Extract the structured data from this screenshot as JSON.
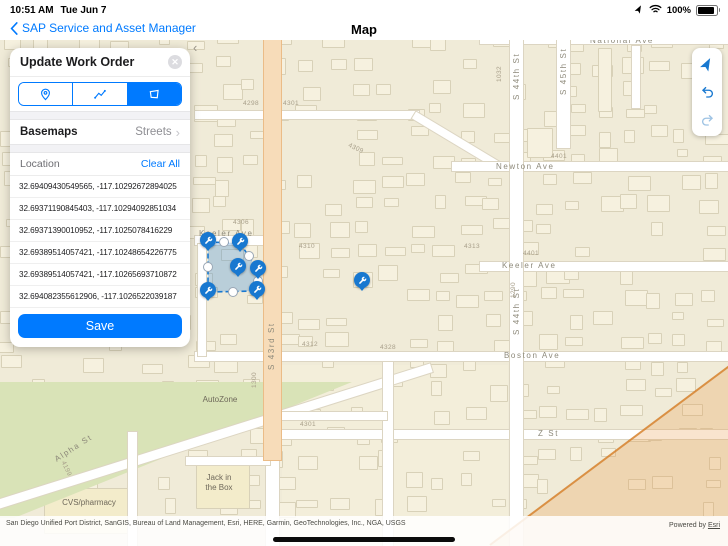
{
  "status_bar": {
    "time": "10:51 AM",
    "date": "Tue Jun 7",
    "battery": "100%"
  },
  "nav_bar": {
    "back_label": "SAP Service and Asset Manager",
    "title": "Map"
  },
  "panel": {
    "title": "Update Work Order",
    "tools": [
      {
        "name": "point",
        "selected": false
      },
      {
        "name": "polyline",
        "selected": false
      },
      {
        "name": "polygon",
        "selected": true
      }
    ],
    "basemaps_label": "Basemaps",
    "basemaps_value": "Streets",
    "location_label": "Location",
    "clear_all_label": "Clear All",
    "coordinates": [
      "32.69409430549565, -117.10292672894025",
      "32.69371190845403, -117.10294092851034",
      "32.69371390010952, -117.1025078416229",
      "32.69389514057421, -117.10248654226775",
      "32.69389514057421, -117.10265693710872",
      "32.694082355612906, -117.1026522039187"
    ],
    "save_label": "Save"
  },
  "map": {
    "street_labels": [
      {
        "text": "National Ave",
        "x": 590,
        "y": -4,
        "rot": 0
      },
      {
        "text": "Newton Ave",
        "x": 496,
        "y": 122,
        "rot": 0
      },
      {
        "text": "Keeler Ave",
        "x": 199,
        "y": 189,
        "rot": 0
      },
      {
        "text": "Keeler Ave",
        "x": 502,
        "y": 221,
        "rot": 0
      },
      {
        "text": "Boston Ave",
        "x": 504,
        "y": 311,
        "rot": 0
      },
      {
        "text": "Z St",
        "x": 538,
        "y": 389,
        "rot": 0
      },
      {
        "text": "Alpha St",
        "x": 53,
        "y": 416,
        "rot": -33
      },
      {
        "text": "S 43rd St",
        "x": 267,
        "y": 330,
        "rot": -90
      },
      {
        "text": "S 44th St",
        "x": 512,
        "y": 60,
        "rot": -90
      },
      {
        "text": "S 44th St",
        "x": 512,
        "y": 295,
        "rot": -90
      },
      {
        "text": "S 45th St",
        "x": 559,
        "y": 55,
        "rot": -90
      }
    ],
    "house_numbers": [
      {
        "text": "4298",
        "x": 243,
        "y": 60,
        "rot": 0
      },
      {
        "text": "4301",
        "x": 283,
        "y": 60,
        "rot": 0
      },
      {
        "text": "4309",
        "x": 350,
        "y": 102,
        "rot": 25
      },
      {
        "text": "4306",
        "x": 233,
        "y": 179,
        "rot": 0
      },
      {
        "text": "4401",
        "x": 551,
        "y": 113,
        "rot": 0
      },
      {
        "text": "4310",
        "x": 299,
        "y": 203,
        "rot": 0
      },
      {
        "text": "4313",
        "x": 464,
        "y": 203,
        "rot": 0
      },
      {
        "text": "4401",
        "x": 523,
        "y": 210,
        "rot": 0
      },
      {
        "text": "4312",
        "x": 302,
        "y": 301,
        "rot": 0
      },
      {
        "text": "4328",
        "x": 380,
        "y": 304,
        "rot": 0
      },
      {
        "text": "4301",
        "x": 300,
        "y": 381,
        "rot": 0
      },
      {
        "text": "1032",
        "x": 496,
        "y": 42,
        "rot": -90
      },
      {
        "text": "1290",
        "x": 510,
        "y": 258,
        "rot": -90
      },
      {
        "text": "1300",
        "x": 251,
        "y": 348,
        "rot": -90
      },
      {
        "text": "4199",
        "x": 66,
        "y": 420,
        "rot": 65
      }
    ],
    "poi_labels": [
      {
        "lines": [
          "AutoZone"
        ],
        "x": 220,
        "y": 355
      },
      {
        "lines": [
          "Jack in",
          "the Box"
        ],
        "x": 219,
        "y": 433
      },
      {
        "lines": [
          "CVS/pharmacy"
        ],
        "x": 89,
        "y": 458
      }
    ],
    "markers": [
      {
        "x": 208,
        "y": 202
      },
      {
        "x": 240,
        "y": 203
      },
      {
        "x": 238,
        "y": 228
      },
      {
        "x": 258,
        "y": 230
      },
      {
        "x": 208,
        "y": 252
      },
      {
        "x": 257,
        "y": 251
      },
      {
        "x": 362,
        "y": 242
      }
    ],
    "selection_polygon": {
      "points": [
        [
          208,
          202
        ],
        [
          240,
          203
        ],
        [
          258,
          230
        ],
        [
          257,
          251
        ],
        [
          208,
          252
        ]
      ],
      "handles": [
        [
          224,
          202
        ],
        [
          249,
          216
        ],
        [
          258,
          241
        ],
        [
          233,
          252
        ],
        [
          208,
          227
        ]
      ]
    },
    "collapse_chevron": "‹",
    "colors": {
      "base": "#F0EBD8",
      "road": "#FFFFFF",
      "major_road": "#F7DCB9",
      "park": "#D9E3B7",
      "marker": "#1878D0",
      "zone": "#E8953C",
      "accent": "#007AFF"
    }
  },
  "map_tools": [
    {
      "name": "locate",
      "enabled": true
    },
    {
      "name": "undo",
      "enabled": true
    },
    {
      "name": "redo",
      "enabled": false
    }
  ],
  "attribution": {
    "sources": "San Diego Unified Port District, SanGIS, Bureau of Land Management, Esri, HERE, Garmin, GeoTechnologies, Inc., NGA, USGS",
    "powered_by": "Powered by",
    "powered_by_link": "Esri"
  }
}
